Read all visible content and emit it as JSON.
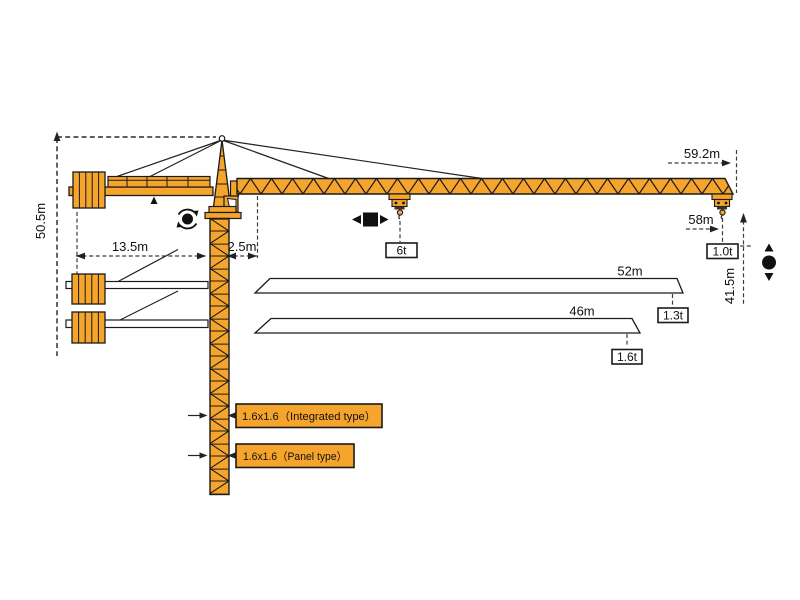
{
  "diagram": {
    "type": "tower-crane-specification-drawing",
    "colors": {
      "crane_orange": "#F5A42C",
      "outline": "#1A1A1A",
      "dimension_line": "#3C3C3C",
      "background": "#FFFFFF"
    },
    "dim": {
      "total_height": "50.5m",
      "counter_radius": "13.5m",
      "slew_offset": "2.5m",
      "max_radius": "59.2m",
      "tip_radius": "58m",
      "hook_height": "41.5m"
    },
    "loads": {
      "max": "6t",
      "at_max_radius": "1.0t"
    },
    "jibs": [
      {
        "length": "52m",
        "tip_load": "1.3t"
      },
      {
        "length": "46m",
        "tip_load": "1.6t"
      }
    ],
    "masts": [
      {
        "label": "1.6x1.6（Integrated type）"
      },
      {
        "label": "1.6x1.6（Panel type）"
      }
    ],
    "icons": {
      "slewing": "rotation-symbol",
      "trolley_travel": "left-right-symbol",
      "hoisting": "up-down-symbol"
    }
  }
}
